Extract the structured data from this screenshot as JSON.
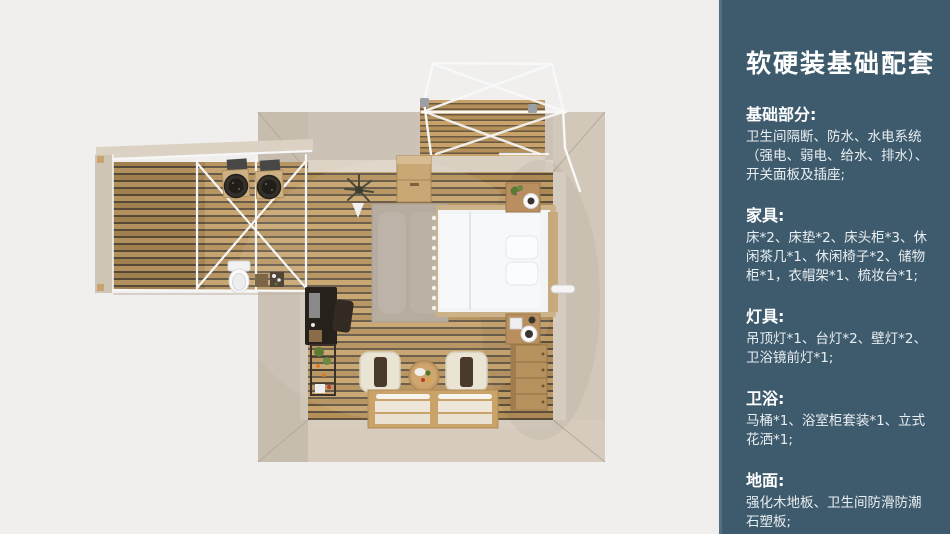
{
  "panel": {
    "title": "软硬装基础配套",
    "accent_color": "#3e5b6d",
    "text_color": "#ffffff",
    "sections": [
      {
        "heading": "基础部分:",
        "body": "卫生间隔断、防水、水电系统\n（强电、弱电、给水、排水）、\n开关面板及插座;"
      },
      {
        "heading": "家具:",
        "body": "床*2、床垫*2、床头柜*3、休\n闲茶几*1、休闲椅子*2、储物\n柜*1，衣帽架*1、梳妆台*1;"
      },
      {
        "heading": "灯具:",
        "body": "吊顶灯*1、台灯*2、壁灯*2、\n卫浴镜前灯*1;"
      },
      {
        "heading": "卫浴:",
        "body": "马桶*1、浴室柜套装*1、立式\n花洒*1;"
      },
      {
        "heading": "地面:",
        "body": "强化木地板、卫生间防滑防潮\n石塑板;"
      }
    ]
  },
  "floorplan": {
    "colors": {
      "background": "#f0efee",
      "wall_beige": "#cfc5b8",
      "floor_wood": "#c09a63",
      "floor_gap": "#60523f",
      "bed_white": "#f3f4f6",
      "frame_white": "#f8f8f8",
      "furniture_wood": "#b7915e"
    },
    "areas": [
      "bedroom",
      "bathroom",
      "left-deck",
      "top-deck"
    ],
    "items": [
      "double-bed",
      "pillow-2",
      "headboard",
      "nightstand-2",
      "table-lamp",
      "flower-vase",
      "rug",
      "armchair-2",
      "coffee-table",
      "tatami-platform-bed",
      "dresser",
      "dressing-table",
      "desk-chair",
      "ladder-shelf",
      "storage-cabinet",
      "plant",
      "watering-can",
      "wall-lamp",
      "toilet",
      "wash-basin-2",
      "vanity-mirror-2",
      "canopy-frame",
      "truss-wall"
    ]
  }
}
